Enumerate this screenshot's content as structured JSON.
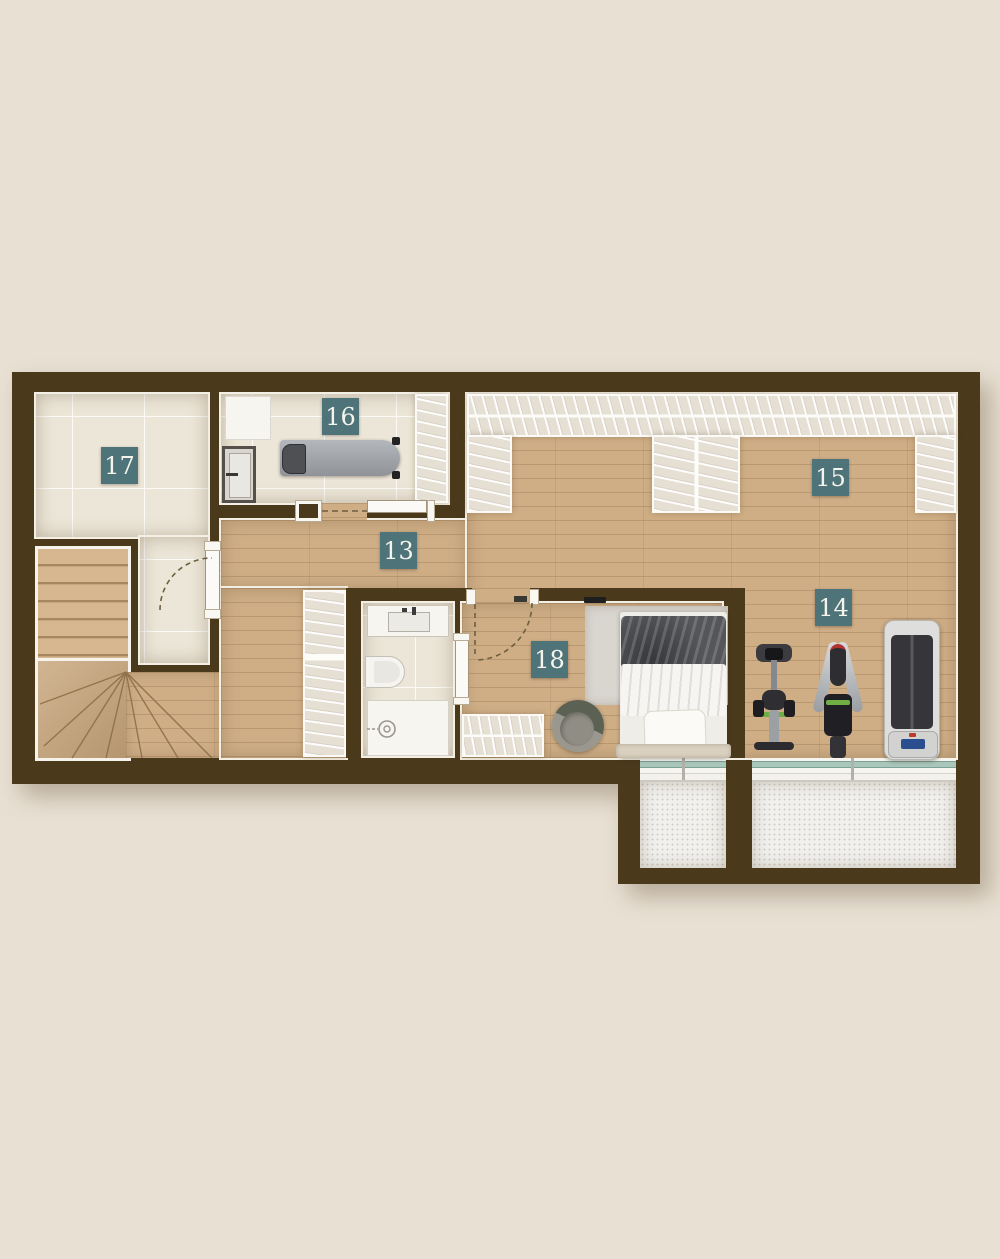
{
  "plan": {
    "kind": "residential upper-floor plan, top-down render",
    "room_labels": {
      "r13": "13",
      "r14": "14",
      "r15": "15",
      "r16": "16",
      "r17": "17",
      "r18": "18"
    },
    "colors": {
      "page_background": "#e8e0d3",
      "wall": "#4a3a1b",
      "wood_floor": "#cfae86",
      "tile_floor": "#ece6d8",
      "label_teal": "#4e7378",
      "label_text": "#f4f4ec",
      "terrace_floor": "#f1f0ed",
      "window_glass": "#a9c6bb",
      "trim_white": "#f4efe4"
    }
  }
}
